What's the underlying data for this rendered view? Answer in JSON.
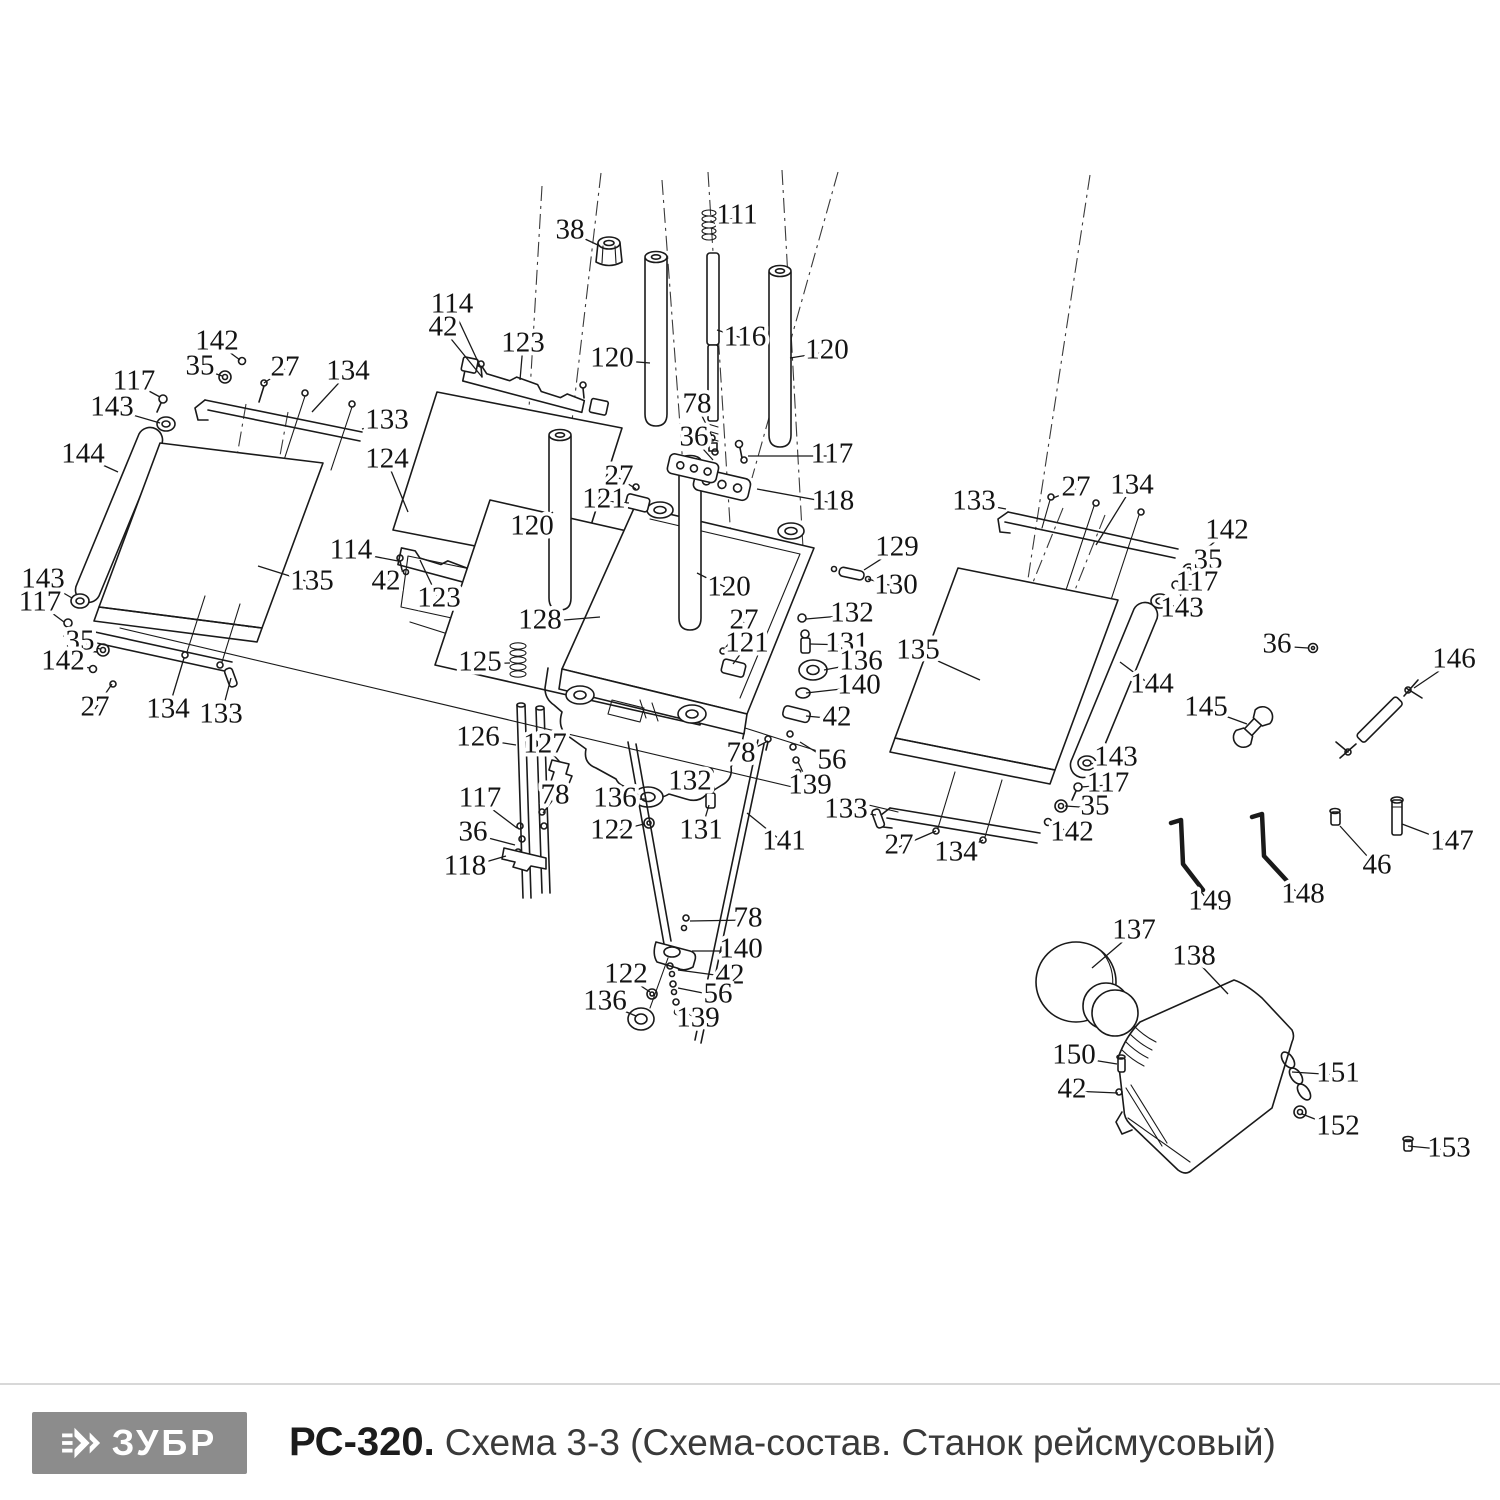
{
  "footer": {
    "brand": "ЗУБР",
    "model": "РС-320.",
    "caption": "Схема 3-3 (Схема-состав. Станок рейсмусовый)",
    "logo_bg": "#8c8c8c",
    "line_color": "#1a1a1a"
  },
  "diagram": {
    "labels": [
      [
        "38",
        570,
        232,
        600,
        246
      ],
      [
        "111",
        737,
        217,
        716,
        224
      ],
      [
        "114",
        452,
        306,
        480,
        366
      ],
      [
        "42",
        443,
        329,
        482,
        377
      ],
      [
        "123",
        523,
        345,
        520,
        380
      ],
      [
        "120",
        612,
        360,
        650,
        363
      ],
      [
        "116",
        745,
        339,
        717,
        330
      ],
      [
        "120",
        827,
        352,
        790,
        358
      ],
      [
        "78",
        697,
        406,
        712,
        436
      ],
      [
        "36",
        694,
        439,
        713,
        460
      ],
      [
        "117",
        832,
        456,
        748,
        456
      ],
      [
        "27",
        619,
        478,
        636,
        489
      ],
      [
        "121",
        604,
        501,
        629,
        503
      ],
      [
        "118",
        833,
        503,
        757,
        489
      ],
      [
        "142",
        217,
        343,
        240,
        360
      ],
      [
        "35",
        200,
        368,
        222,
        376
      ],
      [
        "27",
        285,
        369,
        264,
        383
      ],
      [
        "117",
        134,
        383,
        160,
        397
      ],
      [
        "134",
        348,
        373,
        312,
        412
      ],
      [
        "143",
        112,
        409,
        160,
        423
      ],
      [
        "133",
        387,
        422,
        362,
        429
      ],
      [
        "144",
        83,
        456,
        118,
        472
      ],
      [
        "124",
        387,
        461,
        408,
        512
      ],
      [
        "114",
        351,
        552,
        398,
        561
      ],
      [
        "42",
        386,
        583,
        404,
        570
      ],
      [
        "135",
        312,
        583,
        258,
        566
      ],
      [
        "123",
        439,
        600,
        420,
        560
      ],
      [
        "143",
        43,
        581,
        72,
        598
      ],
      [
        "117",
        40,
        604,
        64,
        622
      ],
      [
        "35",
        80,
        643,
        100,
        649
      ],
      [
        "142",
        63,
        663,
        90,
        668
      ],
      [
        "27",
        95,
        709,
        112,
        684
      ],
      [
        "134",
        168,
        711,
        184,
        658
      ],
      [
        "133",
        221,
        716,
        231,
        678
      ],
      [
        "120",
        532,
        528,
        553,
        512
      ],
      [
        "128",
        540,
        622,
        600,
        617
      ],
      [
        "120",
        729,
        589,
        697,
        573
      ],
      [
        "125",
        480,
        664,
        510,
        663
      ],
      [
        "126",
        478,
        739,
        516,
        745
      ],
      [
        "127",
        545,
        746,
        560,
        762
      ],
      [
        "27",
        744,
        622,
        724,
        650
      ],
      [
        "121",
        747,
        645,
        733,
        664
      ],
      [
        "129",
        897,
        549,
        864,
        570
      ],
      [
        "130",
        896,
        587,
        868,
        579
      ],
      [
        "132",
        852,
        615,
        806,
        619
      ],
      [
        "131",
        847,
        645,
        810,
        644
      ],
      [
        "136",
        861,
        663,
        824,
        670
      ],
      [
        "140",
        859,
        687,
        806,
        693
      ],
      [
        "42",
        837,
        719,
        806,
        716
      ],
      [
        "56",
        832,
        762,
        800,
        742
      ],
      [
        "139",
        810,
        787,
        798,
        762
      ],
      [
        "78",
        741,
        755,
        768,
        741
      ],
      [
        "132",
        690,
        783,
        707,
        772
      ],
      [
        "117",
        480,
        800,
        517,
        828
      ],
      [
        "78",
        555,
        797,
        543,
        813
      ],
      [
        "136",
        615,
        800,
        645,
        799
      ],
      [
        "36",
        473,
        834,
        515,
        845
      ],
      [
        "122",
        612,
        832,
        644,
        824
      ],
      [
        "131",
        701,
        832,
        709,
        805
      ],
      [
        "118",
        465,
        868,
        506,
        856
      ],
      [
        "141",
        784,
        843,
        747,
        813
      ],
      [
        "133",
        846,
        811,
        876,
        815
      ],
      [
        "27",
        899,
        847,
        936,
        831
      ],
      [
        "134",
        956,
        854,
        983,
        840
      ],
      [
        "133",
        974,
        503,
        1006,
        509
      ],
      [
        "27",
        1076,
        489,
        1053,
        498
      ],
      [
        "134",
        1132,
        487,
        1096,
        545
      ],
      [
        "142",
        1227,
        532,
        1202,
        552
      ],
      [
        "35",
        1208,
        562,
        1190,
        569
      ],
      [
        "117",
        1197,
        584,
        1178,
        585
      ],
      [
        "143",
        1182,
        610,
        1163,
        601
      ],
      [
        "135",
        918,
        652,
        980,
        680
      ],
      [
        "36",
        1277,
        646,
        1308,
        648
      ],
      [
        "144",
        1152,
        686,
        1120,
        662
      ],
      [
        "145",
        1206,
        709,
        1247,
        724
      ],
      [
        "146",
        1454,
        661,
        1414,
        688
      ],
      [
        "143",
        1116,
        759,
        1090,
        764
      ],
      [
        "117",
        1108,
        785,
        1081,
        787
      ],
      [
        "35",
        1095,
        808,
        1065,
        806
      ],
      [
        "142",
        1072,
        834,
        1051,
        823
      ],
      [
        "147",
        1452,
        843,
        1402,
        824
      ],
      [
        "46",
        1377,
        867,
        1340,
        826
      ],
      [
        "149",
        1210,
        903,
        1198,
        888
      ],
      [
        "148",
        1303,
        896,
        1286,
        884
      ],
      [
        "78",
        748,
        920,
        690,
        921
      ],
      [
        "140",
        741,
        951,
        692,
        951
      ],
      [
        "122",
        626,
        976,
        650,
        992
      ],
      [
        "42",
        730,
        977,
        678,
        970
      ],
      [
        "56",
        718,
        996,
        678,
        988
      ],
      [
        "136",
        605,
        1003,
        636,
        1016
      ],
      [
        "139",
        698,
        1020,
        680,
        1008
      ],
      [
        "137",
        1134,
        932,
        1092,
        968
      ],
      [
        "138",
        1194,
        958,
        1228,
        994
      ],
      [
        "150",
        1074,
        1057,
        1117,
        1064
      ],
      [
        "42",
        1072,
        1091,
        1118,
        1093
      ],
      [
        "151",
        1338,
        1075,
        1292,
        1072
      ],
      [
        "152",
        1338,
        1128,
        1302,
        1114
      ],
      [
        "153",
        1449,
        1150,
        1408,
        1146
      ]
    ]
  }
}
